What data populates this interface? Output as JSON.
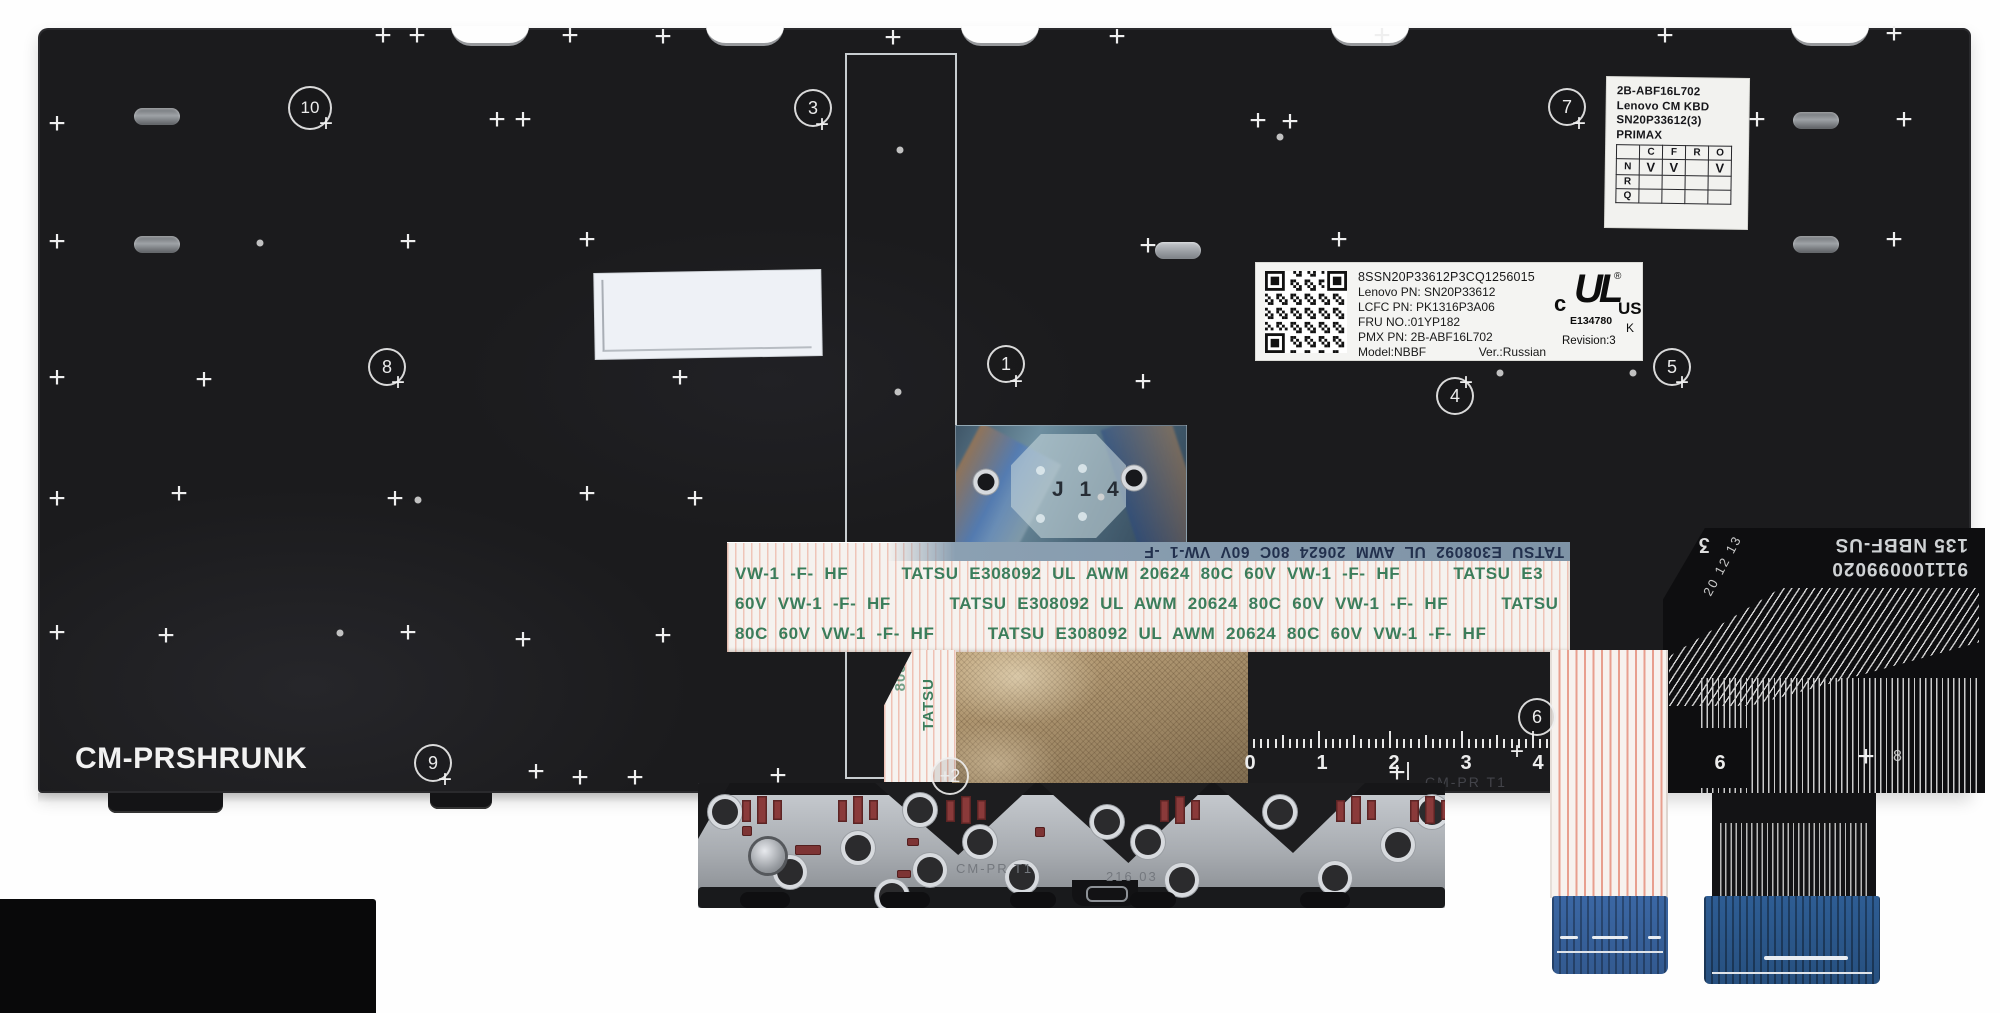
{
  "photo": {
    "subject": "laptop keyboard backplate product photo"
  },
  "markings": {
    "plate_print": "CM-PRSHRUNK",
    "plate_etch": "CM-PR  T1",
    "bracket_etch_left": "CM-PR  T1",
    "bracket_etch_right": "216  03",
    "film_label": "J 1 4",
    "flex_serial": "911100099020",
    "flex_model": "135 NBBF-US",
    "flex_stamp": "20 12 13",
    "flex_logo": "ʒ",
    "flex_digit8": "8"
  },
  "cable": {
    "mirror": "TATSU  E308092  UL  AWM  20624  80C  60V  VW-1  -F",
    "row1": "VW-1  -F-  HF          TATSU  E308092  UL  AWM  20624  80C  60V  VW-1  -F-  HF          TATSU  E3",
    "row2": "60V  VW-1  -F-  HF           TATSU  E308092  UL  AWM  20624  80C  60V  VW-1  -F-  HF          TATSU",
    "row3": "80C  60V  VW-1  -F-  HF          TATSU  E308092  UL  AWM  20624  80C  60V  VW-1  -F-  HF",
    "vert_a": "TATSU",
    "vert_b": "8080"
  },
  "labels": {
    "spec": {
      "line1": "2B-ABF16L702",
      "line2": "Lenovo CM KBD",
      "line3": "SN20P33612(3)",
      "line4": "PRIMAX",
      "table": {
        "header": [
          "",
          "C",
          "F",
          "R",
          "O"
        ],
        "rows": [
          [
            "N",
            "V",
            "V",
            "",
            "V"
          ],
          [
            "R",
            "",
            "",
            "",
            ""
          ],
          [
            "Q",
            "",
            "",
            "",
            ""
          ]
        ]
      }
    },
    "part": {
      "code": "8SSN20P33612P3CQ1256015",
      "line1": "Lenovo PN: SN20P33612",
      "line2": "LCFC PN: PK1316P3A06",
      "line3": "FRU NO.:01YP182",
      "line4": "PMX PN: 2B-ABF16L702",
      "model": "Model:NBBF",
      "version": "Ver.:Russian",
      "ul_c": "c",
      "ul_mark": "UL",
      "ul_reg": "®",
      "ul_us": "US",
      "ul_file": "E134780",
      "ul_k": "K",
      "revision": "Revision:3"
    }
  },
  "ruler": {
    "numbers": [
      {
        "t": "0",
        "x": 1250
      },
      {
        "t": "1",
        "x": 1322
      },
      {
        "t": "2",
        "x": 1394
      },
      {
        "t": "3",
        "x": 1466
      },
      {
        "t": "4",
        "x": 1538
      },
      {
        "t": "6",
        "x": 1720
      }
    ],
    "segments": [
      {
        "start": 1246,
        "end": 1566
      },
      {
        "start": 1662,
        "end": 1700
      }
    ],
    "step": 7.15,
    "baseline": 748,
    "number_y": 752
  },
  "scene": {
    "callouts": [
      {
        "label": "1",
        "x": 1006,
        "y": 364,
        "plus": [
          10,
          18
        ]
      },
      {
        "label": "+2",
        "x": 950,
        "y": 776
      },
      {
        "label": "3",
        "x": 813,
        "y": 108,
        "plus": [
          9,
          17
        ]
      },
      {
        "label": "4",
        "x": 1455,
        "y": 396,
        "plus": [
          11,
          -13
        ]
      },
      {
        "label": "5",
        "x": 1672,
        "y": 367,
        "plus": [
          10,
          16
        ]
      },
      {
        "label": "6",
        "x": 1537,
        "y": 717,
        "plus": [
          -20,
          35
        ]
      },
      {
        "label": "7",
        "x": 1567,
        "y": 107,
        "plus": [
          12,
          17
        ]
      },
      {
        "label": "8",
        "x": 387,
        "y": 367,
        "plus": [
          11,
          16
        ]
      },
      {
        "label": "9",
        "x": 433,
        "y": 763,
        "plus": [
          12,
          17
        ]
      },
      {
        "label": "10",
        "x": 310,
        "y": 108,
        "wide": true,
        "plus": [
          16,
          16
        ]
      }
    ],
    "fiducials": [
      [
        383,
        36
      ],
      [
        417,
        36
      ],
      [
        570,
        36
      ],
      [
        663,
        37
      ],
      [
        893,
        38
      ],
      [
        1117,
        37
      ],
      [
        1382,
        36
      ],
      [
        1665,
        36
      ],
      [
        1894,
        34
      ],
      [
        57,
        124
      ],
      [
        497,
        120
      ],
      [
        523,
        120
      ],
      [
        1258,
        121
      ],
      [
        1290,
        122
      ],
      [
        1757,
        120
      ],
      [
        1904,
        120
      ],
      [
        57,
        242
      ],
      [
        408,
        242
      ],
      [
        587,
        240
      ],
      [
        1148,
        246
      ],
      [
        1339,
        240
      ],
      [
        1894,
        240
      ],
      [
        57,
        378
      ],
      [
        204,
        380
      ],
      [
        680,
        378
      ],
      [
        1143,
        382
      ],
      [
        57,
        499
      ],
      [
        179,
        494
      ],
      [
        395,
        499
      ],
      [
        587,
        494
      ],
      [
        695,
        499
      ],
      [
        57,
        633
      ],
      [
        166,
        636
      ],
      [
        408,
        633
      ],
      [
        523,
        640
      ],
      [
        663,
        636
      ],
      [
        536,
        772
      ],
      [
        580,
        778
      ],
      [
        635,
        778
      ],
      [
        778,
        776
      ],
      [
        1397,
        773
      ],
      [
        1866,
        757
      ]
    ],
    "dots": [
      [
        900,
        150
      ],
      [
        898,
        392
      ],
      [
        1500,
        373
      ],
      [
        1633,
        373
      ],
      [
        418,
        500
      ],
      [
        1101,
        497
      ],
      [
        260,
        243
      ],
      [
        340,
        633
      ],
      [
        1280,
        137
      ]
    ],
    "notches": [
      490,
      745,
      1000,
      1370,
      1830
    ],
    "slots": [
      {
        "x": 134,
        "y": 108
      },
      {
        "x": 134,
        "y": 236
      },
      {
        "x": 1155,
        "y": 242,
        "bright": true
      },
      {
        "x": 1793,
        "y": 112
      },
      {
        "x": 1793,
        "y": 236
      }
    ],
    "plate_tabs": [
      {
        "x": 108,
        "y": 793,
        "w": 115,
        "h": 20
      },
      {
        "x": 430,
        "y": 793,
        "w": 62,
        "h": 16
      }
    ],
    "bracket": {
      "x": 698,
      "y": 783,
      "chevrons": [
        {
          "x": 875,
          "w": 160,
          "h": 72
        },
        {
          "x": 1040,
          "w": 170,
          "h": 80
        },
        {
          "x": 1215,
          "w": 150,
          "h": 70
        }
      ],
      "holes": [
        [
          725,
          812
        ],
        [
          790,
          872
        ],
        [
          858,
          848
        ],
        [
          920,
          810
        ],
        [
          930,
          870
        ],
        [
          892,
          896
        ],
        [
          980,
          842
        ],
        [
          1022,
          877
        ],
        [
          1107,
          822
        ],
        [
          1148,
          842
        ],
        [
          1182,
          880
        ],
        [
          1280,
          812
        ],
        [
          1335,
          878
        ],
        [
          1398,
          845
        ],
        [
          1432,
          812
        ]
      ],
      "pads": [
        [
          762,
          796
        ],
        [
          858,
          796
        ],
        [
          966,
          796
        ],
        [
          1180,
          796
        ],
        [
          1356,
          796
        ],
        [
          1430,
          796
        ]
      ],
      "bits": [
        [
          742,
          826,
          10,
          10
        ],
        [
          907,
          838,
          12,
          8
        ],
        [
          795,
          845,
          26,
          10
        ],
        [
          897,
          870,
          14,
          8
        ],
        [
          1035,
          827,
          10,
          10
        ]
      ],
      "tabs": [
        [
          740,
          50
        ],
        [
          880,
          50
        ],
        [
          1010,
          46
        ],
        [
          1130,
          46
        ],
        [
          1300,
          50
        ]
      ],
      "screw": [
        768,
        856
      ]
    }
  },
  "colors": {
    "plate": "#1c1c1e",
    "cable_text_green": "#3b7d5b",
    "film_blue": "#56788c",
    "mesh_gold": "#b59a74",
    "stiffener_blue": "#35609a",
    "pad_red": "#8a3a3a",
    "background": "#fefefe"
  }
}
